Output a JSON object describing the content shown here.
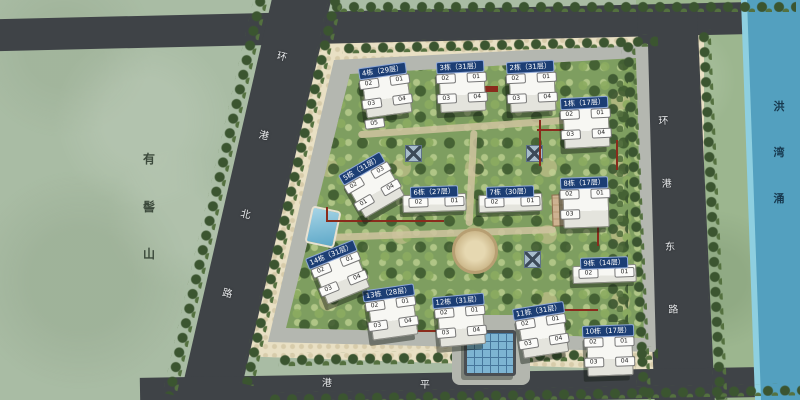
{
  "landmarks": {
    "mountain": "有髻山",
    "river": "洪湾涌",
    "road_west": "环港北路",
    "road_east": "环港东路",
    "road_south": "港平"
  },
  "buildings": [
    {
      "id": "4",
      "label": "4栋（29层）",
      "floors": "29层",
      "x": 352,
      "y": 58,
      "rot": -8,
      "shape": "tower",
      "units": [
        "02",
        "01",
        "03",
        "04",
        "05"
      ]
    },
    {
      "id": "3",
      "label": "3栋（31层）",
      "floors": "31层",
      "x": 430,
      "y": 54,
      "rot": -3,
      "shape": "tower",
      "units": [
        "02",
        "01",
        "03",
        "04"
      ]
    },
    {
      "id": "2",
      "label": "2栋（31层）",
      "floors": "31层",
      "x": 500,
      "y": 54,
      "rot": -3,
      "shape": "tower",
      "units": [
        "02",
        "01",
        "03",
        "04"
      ]
    },
    {
      "id": "1",
      "label": "1栋（17层）",
      "floors": "17层",
      "x": 554,
      "y": 90,
      "rot": -3,
      "shape": "tower",
      "units": [
        "02",
        "01",
        "03",
        "04"
      ]
    },
    {
      "id": "5",
      "label": "5栋（31层）",
      "floors": "31层",
      "x": 330,
      "y": 156,
      "rot": -30,
      "shape": "tower",
      "units": [
        "02",
        "03",
        "01",
        "04"
      ]
    },
    {
      "id": "6",
      "label": "6栋（27层）",
      "floors": "27层",
      "x": 404,
      "y": 179,
      "rot": -2,
      "shape": "slab",
      "units": [
        "02",
        "01"
      ]
    },
    {
      "id": "7",
      "label": "7栋（30层）",
      "floors": "30层",
      "x": 480,
      "y": 179,
      "rot": -2,
      "shape": "slab",
      "units": [
        "02",
        "01"
      ]
    },
    {
      "id": "8",
      "label": "8栋（17层）",
      "floors": "17层",
      "x": 554,
      "y": 170,
      "rot": -2,
      "shape": "tower",
      "units": [
        "02",
        "01",
        "03"
      ]
    },
    {
      "id": "9",
      "label": "9栋（14层）",
      "floors": "14层",
      "x": 574,
      "y": 250,
      "rot": -2,
      "shape": "slab",
      "units": [
        "02",
        "01"
      ]
    },
    {
      "id": "10",
      "label": "10栋（17层）",
      "floors": "17层",
      "x": 578,
      "y": 318,
      "rot": -2,
      "shape": "tower",
      "units": [
        "02",
        "01",
        "03",
        "04"
      ]
    },
    {
      "id": "11",
      "label": "11栋（31层）",
      "floors": "31层",
      "x": 508,
      "y": 298,
      "rot": -9,
      "shape": "tower",
      "units": [
        "02",
        "01",
        "03",
        "04"
      ]
    },
    {
      "id": "12",
      "label": "12栋（31层）",
      "floors": "31层",
      "x": 428,
      "y": 288,
      "rot": -5,
      "shape": "tower",
      "units": [
        "02",
        "01",
        "03",
        "04"
      ]
    },
    {
      "id": "13",
      "label": "13栋（28层）",
      "floors": "28层",
      "x": 358,
      "y": 280,
      "rot": -8,
      "shape": "tower",
      "units": [
        "02",
        "01",
        "03",
        "04"
      ]
    },
    {
      "id": "14",
      "label": "14栋（31层）",
      "floors": "31层",
      "x": 300,
      "y": 242,
      "rot": -22,
      "shape": "tower",
      "units": [
        "02",
        "01",
        "03",
        "04"
      ]
    }
  ],
  "features": {
    "pool": "swimming-pool",
    "canopy": "glass-entrance-canopy",
    "plaza": "central-plaza",
    "court": "paved-court",
    "pads": "fire-truck-pad-x3",
    "fire_lane": "fire-lane-red-line"
  },
  "colors": {
    "water": "#53a0bf",
    "mountain_green": "#a9bca4",
    "riverside_grass": "#9cb68f",
    "road_asphalt": "#3f4347",
    "sidewalk_cream": "#e9e0c4",
    "interior_green": "#7e9e60",
    "loop_road_gray": "#b4b7b0",
    "street_tree": "#3b5530",
    "building_tag_blue": "#1c3e74",
    "fire_lane_red": "#8a2b1c",
    "building_white": "#f7f7f3"
  }
}
